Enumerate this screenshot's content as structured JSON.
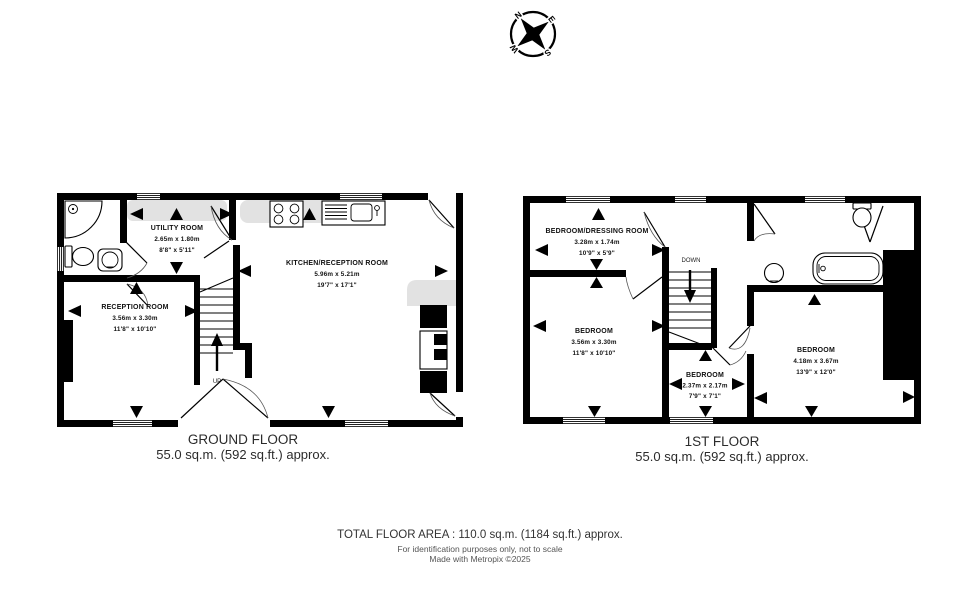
{
  "compass": {
    "north": "N",
    "east": "E",
    "south": "S",
    "west": "W"
  },
  "ground_floor": {
    "title": "GROUND FLOOR",
    "area": "55.0 sq.m. (592 sq.ft.) approx.",
    "stair_label": "UP",
    "rooms": {
      "utility": {
        "name": "UTILITY ROOM",
        "metric": "2.65m x 1.80m",
        "imperial": "8'8\" x 5'11\""
      },
      "kitchen": {
        "name": "KITCHEN/RECEPTION ROOM",
        "metric": "5.96m x 5.21m",
        "imperial": "19'7\" x 17'1\""
      },
      "reception": {
        "name": "RECEPTION ROOM",
        "metric": "3.56m x 3.30m",
        "imperial": "11'8\" x 10'10\""
      }
    }
  },
  "first_floor": {
    "title": "1ST FLOOR",
    "area": "55.0 sq.m. (592 sq.ft.) approx.",
    "stair_label": "DOWN",
    "rooms": {
      "bedroom_dressing": {
        "name": "BEDROOM/DRESSING ROOM",
        "metric": "3.28m x 1.74m",
        "imperial": "10'9\" x 5'9\""
      },
      "bedroom_main": {
        "name": "BEDROOM",
        "metric": "3.56m x 3.30m",
        "imperial": "11'8\" x 10'10\""
      },
      "bedroom_small": {
        "name": "BEDROOM",
        "metric": "2.37m x 2.17m",
        "imperial": "7'9\" x 7'1\""
      },
      "bedroom_right": {
        "name": "BEDROOM",
        "metric": "4.18m x 3.67m",
        "imperial": "13'9\" x 12'0\""
      }
    }
  },
  "footer": {
    "total": "TOTAL FLOOR AREA : 110.0 sq.m. (1184 sq.ft.) approx.",
    "disclaimer": "For identification purposes only, not to scale",
    "credit": "Made with Metropix ©2025"
  },
  "colors": {
    "wall": "#000000",
    "counter": "#e2e2e2",
    "page": "#ffffff"
  }
}
